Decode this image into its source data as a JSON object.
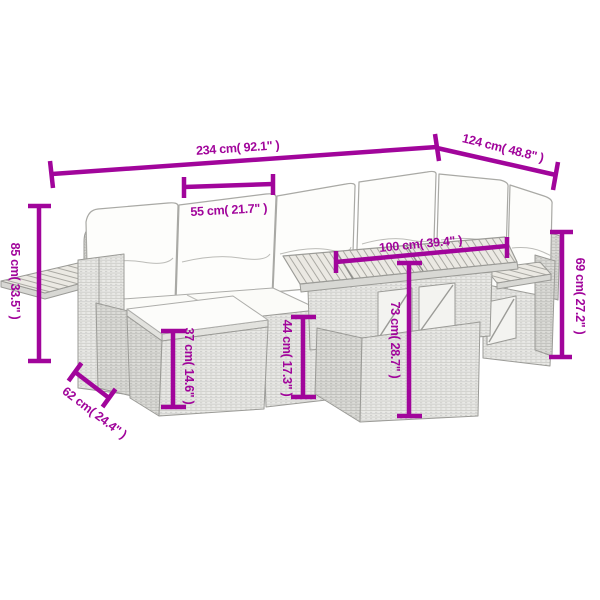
{
  "page": {
    "background": "#ffffff",
    "description": "Dimension diagram of a 7-piece grey poly rattan garden lounge set with cream cushions, acacia wood slat table top, fold-out armrest shelves and an ottoman"
  },
  "style": {
    "accent_color": "#A1059B",
    "line_art_color": "#9b9b97",
    "cushion_color": "#fcfcfa"
  },
  "dimensions": [
    {
      "id": "total-width",
      "label": "234 cm( 92.1\" )"
    },
    {
      "id": "total-depth",
      "label": "124 cm( 48.8\" )"
    },
    {
      "id": "seat-width",
      "label": "55 cm( 21.7\" )"
    },
    {
      "id": "table-width",
      "label": "100 cm( 39.4\" )"
    },
    {
      "id": "back-height",
      "label": "85 cm( 33.5\" )"
    },
    {
      "id": "right-height",
      "label": "69 cm( 27.2\" )"
    },
    {
      "id": "ottoman-height",
      "label": "37 cm( 14.6\" )"
    },
    {
      "id": "seat-height",
      "label": "44 cm( 17.3\" )"
    },
    {
      "id": "table-height",
      "label": "73 cm( 28.7\" )"
    },
    {
      "id": "side-depth",
      "label": "62 cm( 24.4\" )"
    }
  ]
}
